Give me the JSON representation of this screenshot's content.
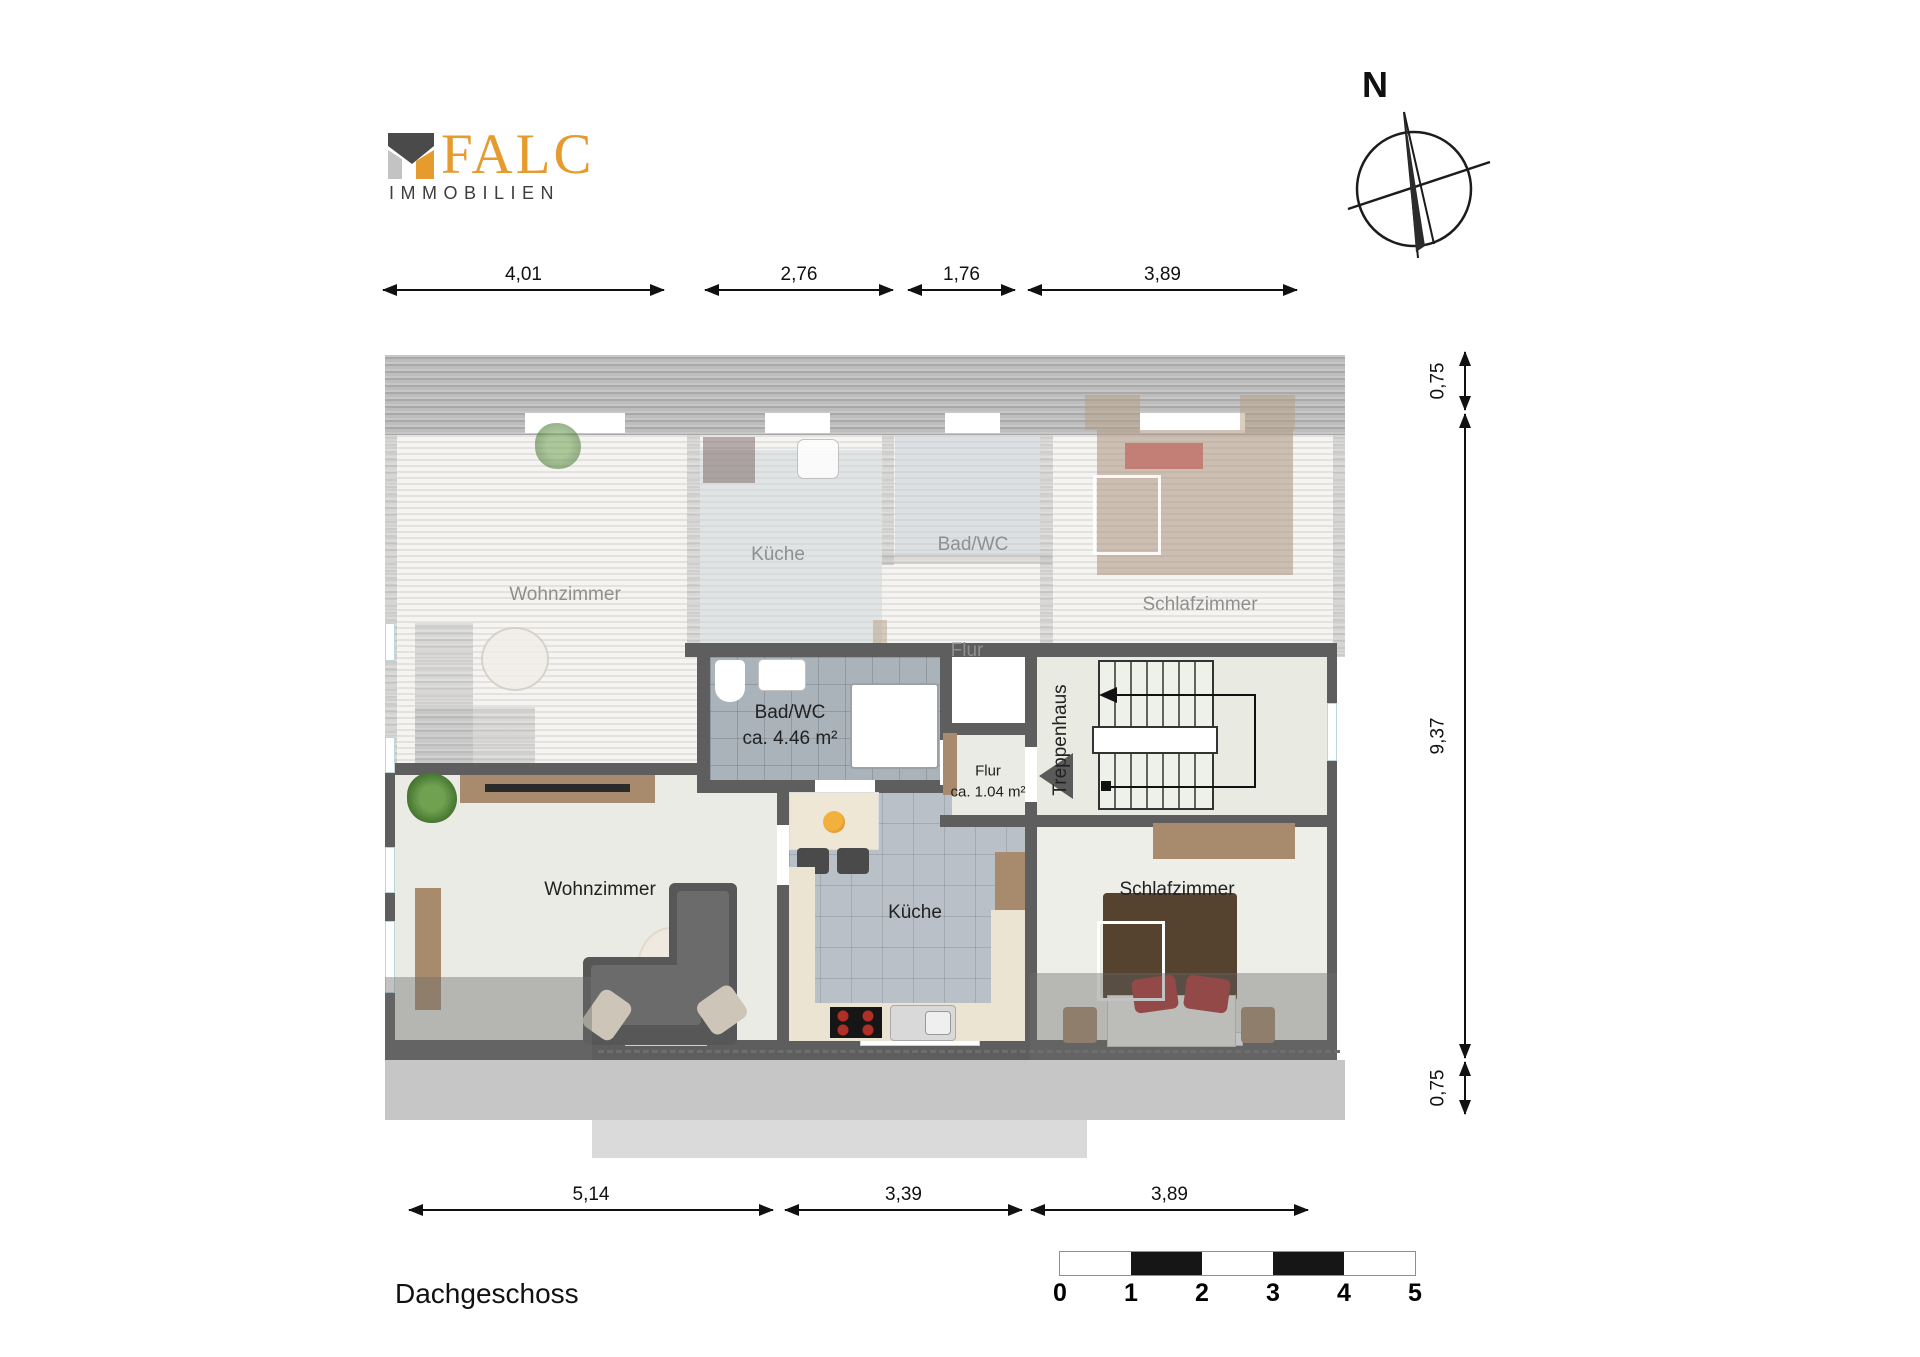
{
  "logo": {
    "brand": "FALC",
    "subtitle": "IMMOBILIEN"
  },
  "compass": {
    "north_label": "N"
  },
  "dimensions": {
    "top": [
      "4,01",
      "2,76",
      "1,76",
      "3,89"
    ],
    "right": [
      "0,75",
      "9,37",
      "0,75"
    ],
    "bottom": [
      "5,14",
      "3,39",
      "3,89"
    ]
  },
  "plan": {
    "upper_apartment": {
      "wohnzimmer": "Wohnzimmer",
      "kueche": "Küche",
      "badwc": "Bad/WC",
      "schlafzimmer": "Schlafzimmer",
      "flur": "Flur"
    },
    "lower_apartment": {
      "badwc_title": "Bad/WC",
      "badwc_area": "ca. 4.46 m²",
      "flur_title": "Flur",
      "flur_area": "ca. 1.04 m²",
      "treppenhaus": "Treppenhaus",
      "wohnzimmer": "Wohnzimmer",
      "kueche": "Küche",
      "schlafzimmer": "Schlafzimmer"
    }
  },
  "scale_bar": {
    "labels": [
      "0",
      "1",
      "2",
      "3",
      "4",
      "5"
    ]
  },
  "footer": {
    "floor_label": "Dachgeschoss"
  },
  "colors": {
    "wall": "#5e5e5e",
    "brand_orange": "#e59b2d",
    "brand_dark": "#3d3d3d",
    "tile_gray": "#b9c0c8",
    "bath_tile_gray": "#aab3ba",
    "floor_light": "#e9ebe4",
    "wood": "#a78b6c",
    "sofa_gray": "#575757",
    "bed_brown": "#55432f",
    "pillow_red": "#ac2f2c",
    "overlay_gray": "#9a9a9a"
  }
}
